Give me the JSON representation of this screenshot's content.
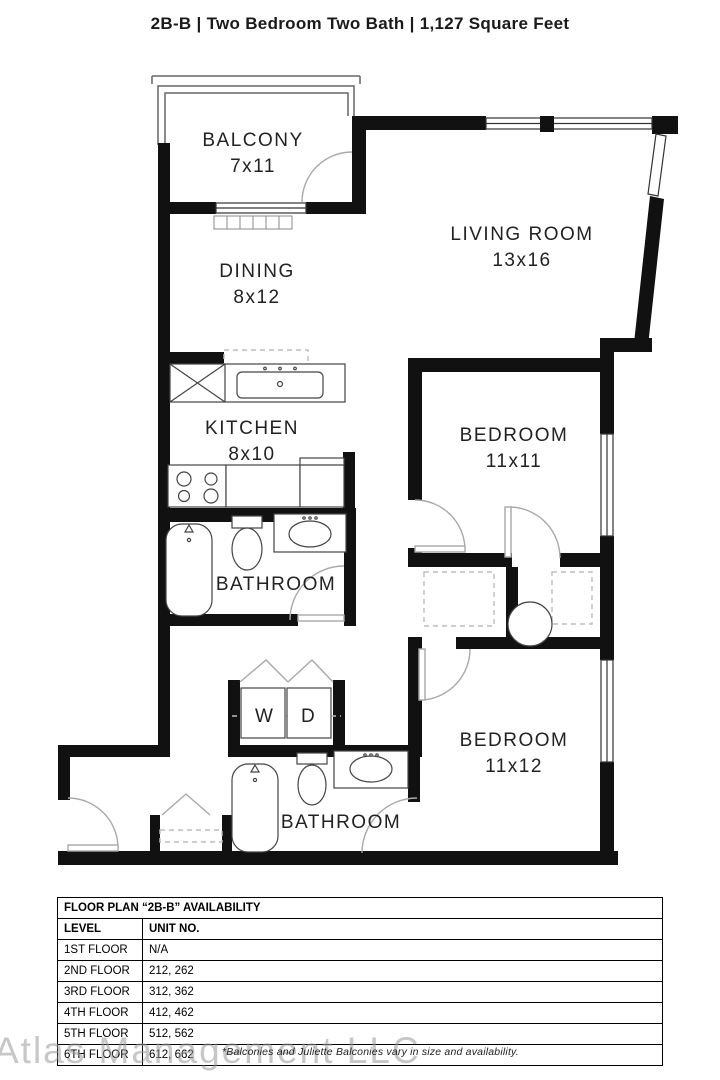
{
  "title": "2B-B | Two Bedroom Two Bath | 1,127 Square Feet",
  "floor_plan": {
    "rooms": [
      {
        "name": "BALCONY",
        "dims": "7x11"
      },
      {
        "name": "DINING",
        "dims": "8x12"
      },
      {
        "name": "LIVING ROOM",
        "dims": "13x16"
      },
      {
        "name": "KITCHEN",
        "dims": "8x10"
      },
      {
        "name": "BATHROOM"
      },
      {
        "name": "BEDROOM",
        "dims": "11x11"
      },
      {
        "name": "BEDROOM",
        "dims": "11x12"
      },
      {
        "name": "BATHROOM"
      }
    ],
    "washer_label": "W",
    "dryer_label": "D"
  },
  "availability_table": {
    "title": "FLOOR PLAN “2B-B” AVAILABILITY",
    "columns": [
      "LEVEL",
      "UNIT NO."
    ],
    "rows": [
      [
        "1ST FLOOR",
        "N/A"
      ],
      [
        "2ND FLOOR",
        "212, 262"
      ],
      [
        "3RD FLOOR",
        "312, 362"
      ],
      [
        "4TH FLOOR",
        "412, 462"
      ],
      [
        "5TH FLOOR",
        "512, 562"
      ],
      [
        "6TH FLOOR",
        "612, 662"
      ]
    ]
  },
  "footnote": "*Balconies and Juliette Balconies vary in size and availability.",
  "watermark": "Atlas Management LLC"
}
